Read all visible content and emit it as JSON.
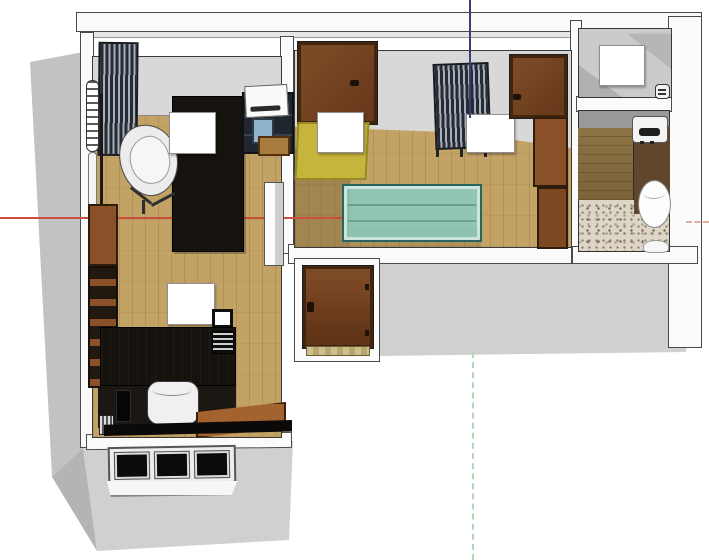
{
  "scene": {
    "type": "3d-floorplan-top-view",
    "description": "Top-down perspective render of a furnished apartment floor plan in a 3D modeling viewport, no visible text",
    "background": "#ffffff"
  },
  "axes": {
    "red_axis": {
      "orientation": "horizontal",
      "style": "solid",
      "color": "#c94e3c"
    },
    "red_axis_negative": {
      "orientation": "horizontal",
      "style": "dashed",
      "color": "#dfae9f"
    },
    "blue_axis": {
      "orientation": "vertical-top",
      "style": "solid",
      "color": "#38406e"
    },
    "green_axis_negative": {
      "orientation": "vertical-bottom",
      "style": "dashed",
      "color": "#aed9b2"
    }
  },
  "colors": {
    "background": "#ffffff",
    "wall_face": "#fbfbfb",
    "wall_edge": "#4a4a4a",
    "facade": "#d0d0d0",
    "facade_dark": "#c2c2c2",
    "facade_bevel": "#b4b4b4",
    "floor_wood": "#c3a266",
    "room_shadow": "#d8d8d8",
    "rug_yellow": "#c6b53c",
    "glass_teal": "#8ccdc4",
    "glass_teal_edge": "#2a665f",
    "door_brown": "#7a4a26",
    "door_frame": "#42250f",
    "cabinet_brown": "#8a5128",
    "furniture_black": "#16130f",
    "rack_dark": "#262b34",
    "rack_light": "#a7adb9",
    "terrazzo_base": "#ddd5c6",
    "deck_wood": "#8d7446",
    "bath_brown": "#5f462c",
    "axis_red": "#c94e3c",
    "axis_red_neg": "#dfae9f",
    "axis_blue": "#38406e",
    "axis_green_neg": "#aed9b2"
  },
  "rooms": [
    {
      "id": "study",
      "label": "Study bedroom, top left, wood floor"
    },
    {
      "id": "living",
      "label": "Living room, center, wood floor with yellow rug"
    },
    {
      "id": "storage",
      "label": "Storage closet, top right, concrete floor"
    },
    {
      "id": "bathroom",
      "label": "Bathroom, right, terrazzo tile and wood deck"
    },
    {
      "id": "office",
      "label": "Office bedroom, bottom left, wood floor"
    },
    {
      "id": "entry",
      "label": "Entrance niche, bottom center, wooden threshold"
    }
  ],
  "furniture": [
    {
      "id": "slatted-shelf-unit",
      "room": "study"
    },
    {
      "id": "vertical-radiator",
      "room": "study"
    },
    {
      "id": "floor-lamp",
      "room": "study"
    },
    {
      "id": "lounge-swivel-chair",
      "room": "study"
    },
    {
      "id": "dark-daybed-table",
      "room": "study"
    },
    {
      "id": "printer-cart-with-printer-monitor-drawer",
      "room": "study"
    },
    {
      "id": "white-photo-card",
      "room": "study"
    },
    {
      "id": "open-entry-door",
      "room": "living"
    },
    {
      "id": "yellow-rug",
      "room": "living"
    },
    {
      "id": "white-photo-card",
      "room": "living"
    },
    {
      "id": "wire-rack-shelf",
      "room": "living"
    },
    {
      "id": "white-photo-card-2",
      "room": "living"
    },
    {
      "id": "open-side-door",
      "room": "living"
    },
    {
      "id": "tall-wardrobe-column",
      "room": "living"
    },
    {
      "id": "teal-glass-coffee-table",
      "room": "living"
    },
    {
      "id": "white-photo-card",
      "room": "storage"
    },
    {
      "id": "small-appliance",
      "room": "storage"
    },
    {
      "id": "water-heater",
      "room": "bathroom"
    },
    {
      "id": "toilet",
      "room": "bathroom"
    },
    {
      "id": "wash-basin",
      "room": "bathroom"
    },
    {
      "id": "wall-cabinet",
      "room": "office"
    },
    {
      "id": "open-shelf-unit",
      "room": "office"
    },
    {
      "id": "white-photo-card",
      "room": "office"
    },
    {
      "id": "tablet",
      "room": "office"
    },
    {
      "id": "black-desk",
      "room": "office"
    },
    {
      "id": "desk-vent-grille",
      "room": "office"
    },
    {
      "id": "office-chair",
      "room": "office"
    },
    {
      "id": "wooden-side-desk",
      "room": "office"
    },
    {
      "id": "pc-tower",
      "room": "office"
    },
    {
      "id": "small-radiator",
      "room": "office"
    },
    {
      "id": "entrance-door",
      "room": "entry"
    },
    {
      "id": "threshold",
      "room": "entry"
    },
    {
      "id": "three-pane-window",
      "room": "office"
    }
  ]
}
